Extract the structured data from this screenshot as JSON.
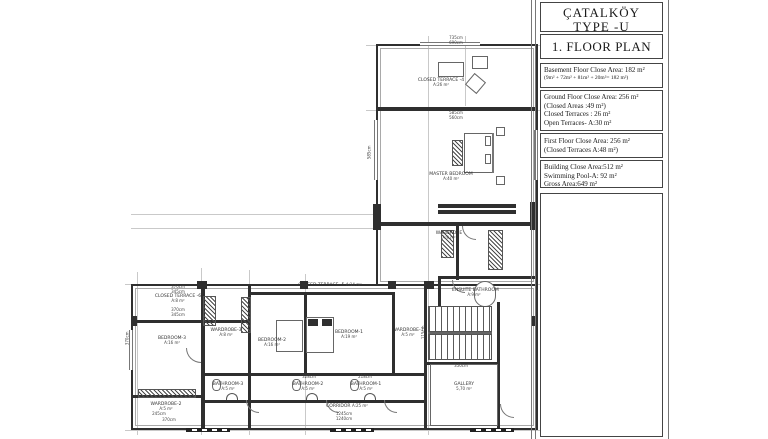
{
  "title_block": {
    "project": "ÇATALKÖY",
    "type_name": "TYPE -U",
    "villa": "VILLA 25",
    "plan_title": "1. FLOOR PLAN",
    "basement_line1": "Basement Floor Close Area: 182 m²",
    "basement_line2": "(9m² + 72m² + 81m² + 20m²= 182 m²)",
    "ground_line1": "Ground Floor Close Area: 256 m²",
    "ground_line2": "(Closed Areas :49 m²)",
    "ground_line3": "Closed Terraces : 26 m²",
    "ground_line4": "Open Terraces- A:30 m²",
    "first_line1": "First Floor Close Area: 256 m²",
    "first_line2": "(Closed Terraces A:48 m²)",
    "building_line1": "Building Close Area:512 m²",
    "building_line2": "Swimming Pool-A: 92 m²",
    "building_line3": "Gross Area:649 m²"
  },
  "plan": {
    "rooms": [
      {
        "name": "CLOSED TERRACE -4",
        "area": "A:26 m²"
      },
      {
        "name": "MASTER BEDROOM",
        "area": "A:40 m²"
      },
      {
        "name": "WARDROBE",
        "area": "A:9 m²"
      },
      {
        "name": "ENSUITE BATHROOM",
        "area": "A:9 m²"
      },
      {
        "name": "CLOSED TERRACE -6",
        "area": "A:8 m²"
      },
      {
        "name": "CLOSED TERRACE -5",
        "area": "A:14 m²"
      },
      {
        "name": "BEDROOM-3",
        "area": "A:16 m²"
      },
      {
        "name": "WARDROBE-3",
        "area": "A:8 m²"
      },
      {
        "name": "BEDROOM-2",
        "area": "A:16 m²"
      },
      {
        "name": "BEDROOM-1",
        "area": "A:19 m²"
      },
      {
        "name": "WARDROBE-1",
        "area": "A:5 m²"
      },
      {
        "name": "GALLERY",
        "area": "5,70 m²"
      },
      {
        "name": "BATHROOM-3",
        "area": "A:5 m²"
      },
      {
        "name": "BATHROOM-2",
        "area": "A:5 m²"
      },
      {
        "name": "BATHROOM-1",
        "area": "A:5 m²"
      },
      {
        "name": "WARDROBE-2",
        "area": "A:5 m²"
      },
      {
        "name": "CORRIDOR",
        "area": "A:25 m²"
      }
    ],
    "dims": [
      "735cm",
      "690cm",
      "585cm",
      "560cm",
      "370cm",
      "345cm",
      "370cm",
      "345cm",
      "1245cm",
      "1240cm",
      "245cm",
      "370cm",
      "350cm",
      "115cm",
      "328cm",
      "218cm",
      "585cm",
      "370cm"
    ]
  }
}
